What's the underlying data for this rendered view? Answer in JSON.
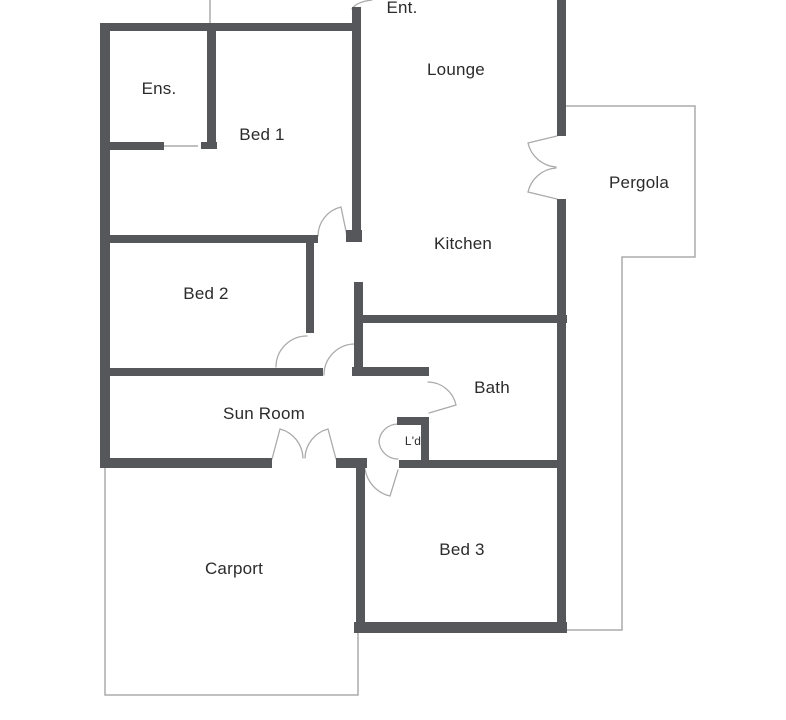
{
  "title": "Floor plan",
  "colors": {
    "wall": "#55575b",
    "thin_outline": "#ababab",
    "door_arc": "#ababab",
    "label_text": "#2b2b2b",
    "background": "#ffffff"
  },
  "rooms": {
    "ent": {
      "label": "Ent."
    },
    "lounge": {
      "label": "Lounge"
    },
    "ens": {
      "label": "Ens."
    },
    "bed1": {
      "label": "Bed 1"
    },
    "pergola": {
      "label": "Pergola"
    },
    "kitchen": {
      "label": "Kitchen"
    },
    "bed2": {
      "label": "Bed 2"
    },
    "bath": {
      "label": "Bath"
    },
    "sun_room": {
      "label": "Sun Room"
    },
    "laundry": {
      "label": "L'd"
    },
    "bed3": {
      "label": "Bed 3"
    },
    "carport": {
      "label": "Carport"
    }
  }
}
